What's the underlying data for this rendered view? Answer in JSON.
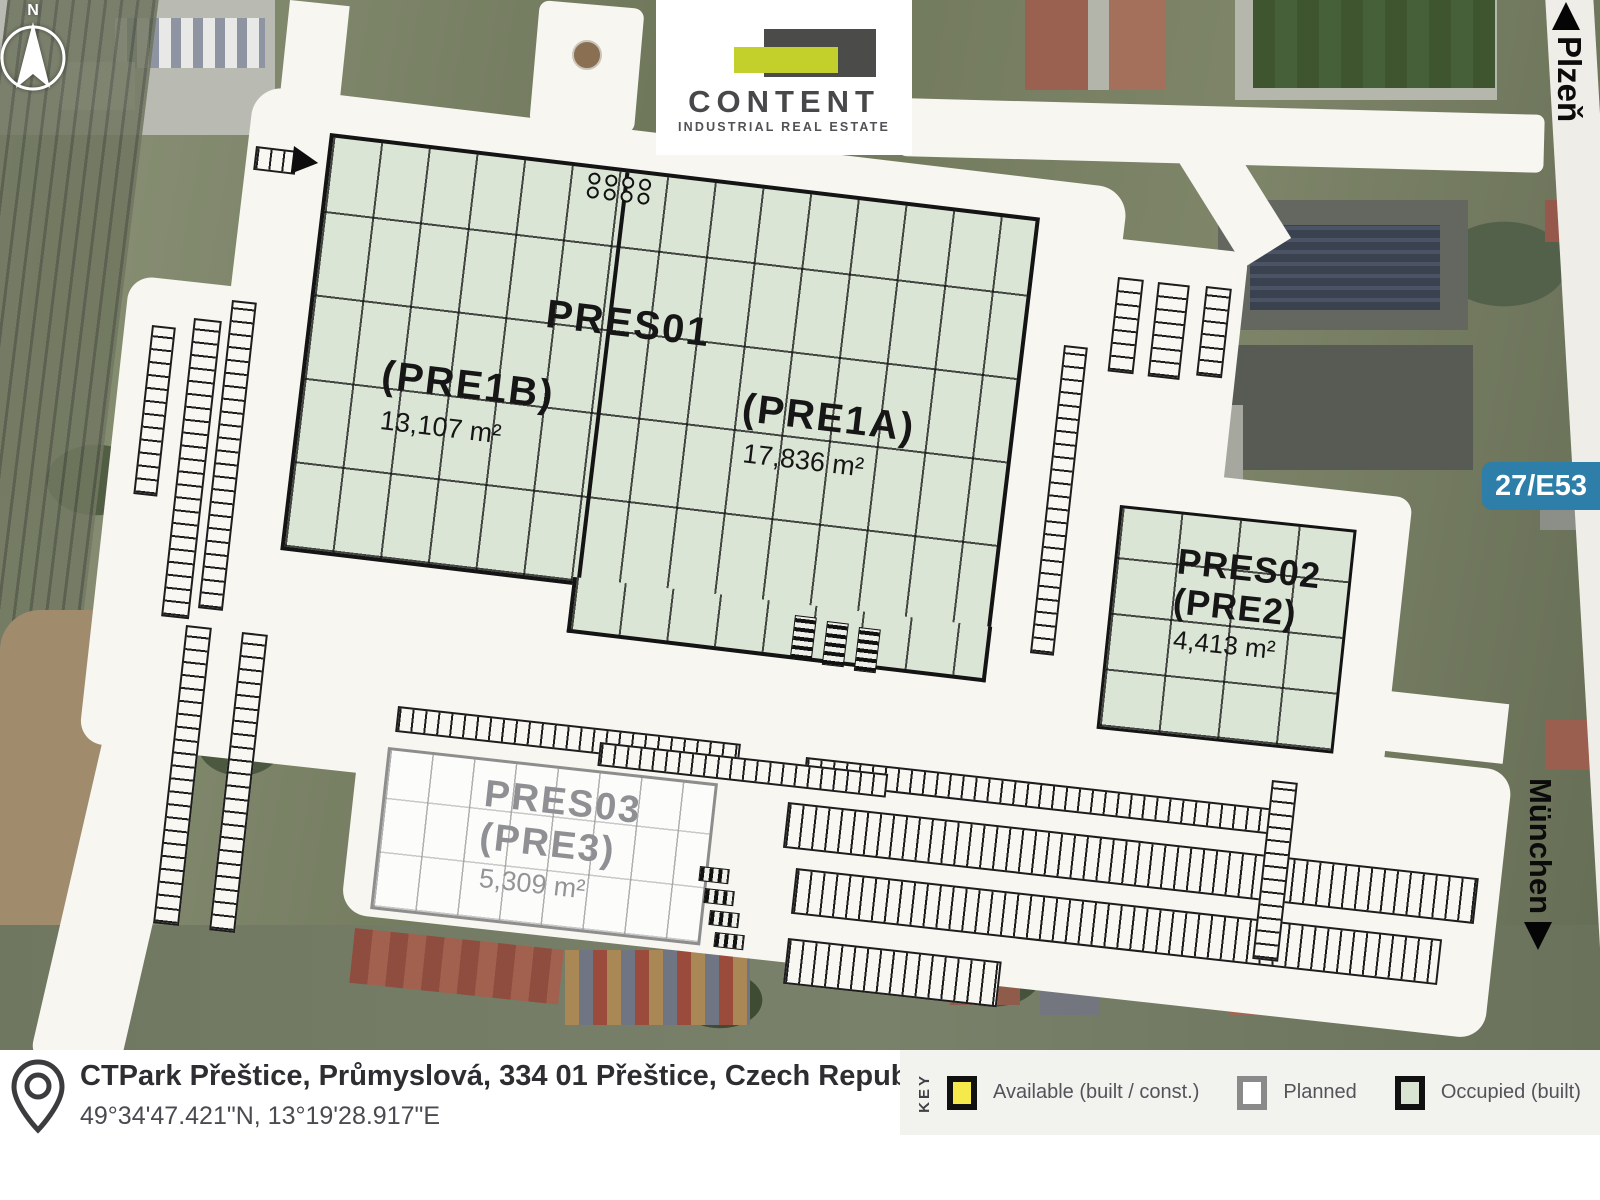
{
  "logo": {
    "brand": "CONTENT",
    "tagline": "INDUSTRIAL REAL ESTATE"
  },
  "compass": {
    "north": "N"
  },
  "roads": {
    "top_destination": "Plzeň",
    "right_destination": "München",
    "route_badge": "27/E53"
  },
  "site": {
    "pres01": {
      "title": "PRES01",
      "unit_b": {
        "code": "(PRE1B)",
        "area": "13,107 m²"
      },
      "unit_a": {
        "code": "(PRE1A)",
        "area": "17,836 m²"
      }
    },
    "pres02": {
      "title": "PRES02",
      "code": "(PRE2)",
      "area": "4,413 m²"
    },
    "pres03": {
      "title": "PRES03",
      "code": "(PRE3)",
      "area": "5,309 m²"
    }
  },
  "footer": {
    "address": "CTPark Přeštice, Průmyslová, 334 01 Přeštice, Czech Republic",
    "coordinates": "49°34'47.421\"N, 13°19'28.917\"E"
  },
  "legend": {
    "title": "KEY",
    "available": "Available (built / const.)",
    "planned": "Planned",
    "occupied": "Occupied (built)"
  },
  "colors": {
    "available_fill": "#f6e94b",
    "available_border": "#111111",
    "planned_fill": "#ffffff",
    "planned_border": "#8a8a8a",
    "occupied_fill": "#d9e4d3",
    "occupied_border": "#111111",
    "badge_bg": "#2d7ea9"
  }
}
